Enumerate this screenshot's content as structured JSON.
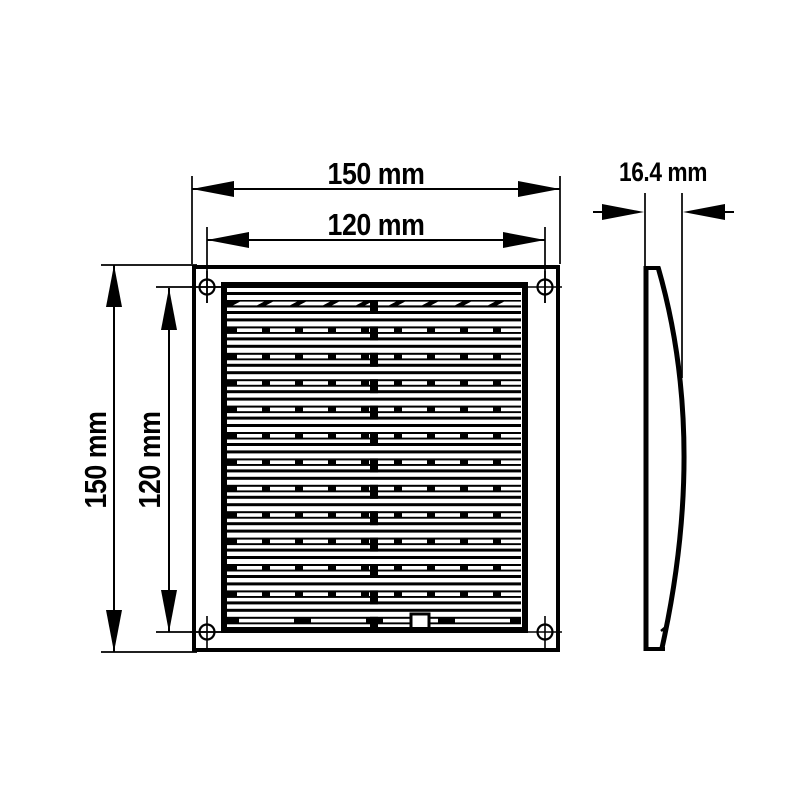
{
  "title": "ventilation-grille-dimension-drawing",
  "labels": {
    "front_width_outer": "150 mm",
    "front_width_inner": "120 mm",
    "front_height_outer": "150 mm",
    "front_height_inner": "120 mm",
    "side_depth": "16.4 mm"
  },
  "colors": {
    "line": "#000000",
    "background": "#ffffff"
  },
  "drawing": {
    "louver_band_count": 13,
    "band_first_y": 300,
    "band_pitch": 26.4,
    "band_height": 7.5,
    "slot_width": 25,
    "slot_step": 33,
    "slot_height": 3.6,
    "long_slot_width": 55,
    "long_slot_step": 72,
    "content": {
      "x0": 227,
      "x1": 521,
      "y0": 288,
      "y1": 627
    },
    "center_tab": {
      "x": 370,
      "width": 8,
      "height": 14
    },
    "latch": {
      "x": 411,
      "y": 614,
      "width": 18,
      "height": 16
    },
    "screw_holes": [
      {
        "cx": 207,
        "cy": 287
      },
      {
        "cx": 545,
        "cy": 287
      },
      {
        "cx": 207,
        "cy": 632
      },
      {
        "cx": 545,
        "cy": 632
      }
    ]
  }
}
